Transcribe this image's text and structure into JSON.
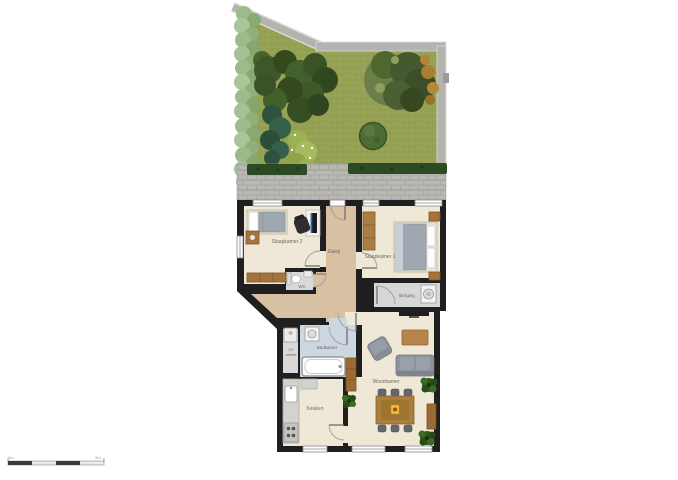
{
  "plan": {
    "type": "floorplan-with-garden",
    "rooms": {
      "slaapkamer2": {
        "label": "Slaapkamer 2"
      },
      "gang": {
        "label": "Gang"
      },
      "slaapkamer1": {
        "label": "Slaapkamer 1"
      },
      "wc": {
        "label": "WC"
      },
      "berging": {
        "label": "Berging"
      },
      "badkamer": {
        "label": "Badkamer"
      },
      "cv_ruimte": {
        "label": "CV ruimte",
        "line1": "CV",
        "line2": "ruimte"
      },
      "keuken": {
        "label": "Keuken"
      },
      "woonkamer": {
        "label": "Woonkamer"
      }
    },
    "scale_bar": {
      "start_label": "0m",
      "end_label": "5m"
    },
    "colors": {
      "grass": "#95a155",
      "hedge_light": "#9cbb8a",
      "hedge_dark": "#2c4a24",
      "garden_wall": "#b4b3ae",
      "terrace_brick": "#b9b8b2",
      "house_wall": "#1f1f1f",
      "floor_cream": "#efe8d6",
      "floor_hall_tan": "#d8c0a2",
      "floor_bath_blue": "#ccd7e1",
      "floor_utility_gray": "#d9d9d9",
      "wood_brown": "#a97d3f",
      "sofa_gray": "#8d939c",
      "plant_green": "#2d591c",
      "table_item_yellow": "#e8c33a",
      "table_item_red": "#c0392b"
    }
  }
}
